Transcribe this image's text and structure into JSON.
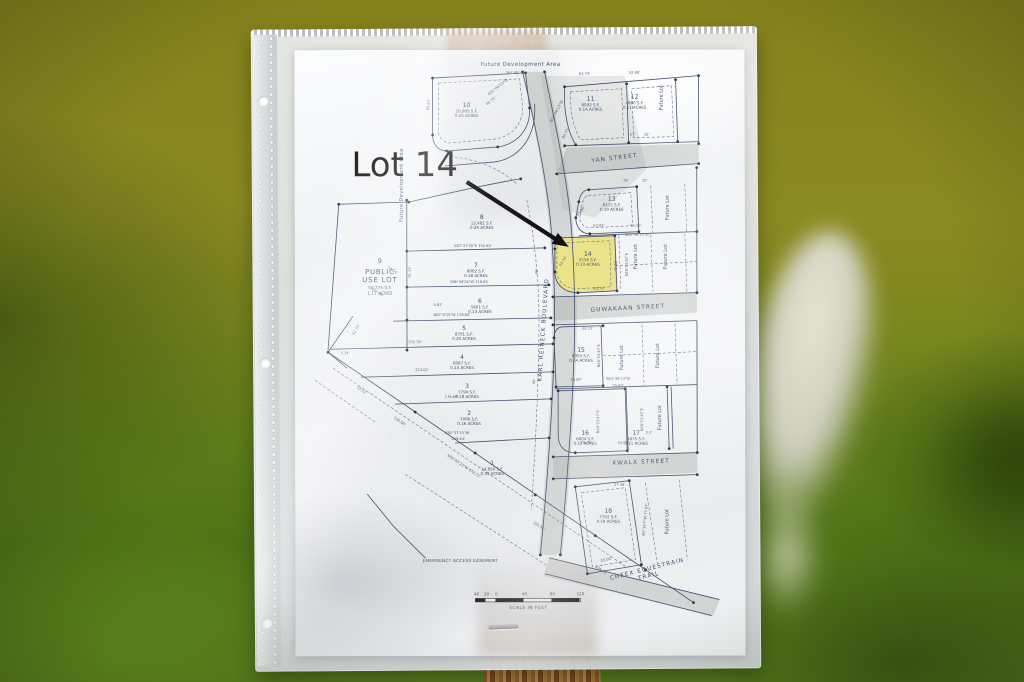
{
  "annotation": {
    "label": "Lot 14"
  },
  "colors": {
    "highlight": "#ece28a",
    "ink": "#44506a",
    "annotation": "#181818"
  },
  "map": {
    "titles": {
      "future_development_top": "Future Development Area",
      "future_development_left": "Future Development Area"
    },
    "public_lot": {
      "number": "9",
      "name_line1": "PUBLIC",
      "name_line2": "USE LOT",
      "area": "50,775 S.F.",
      "acres": "1.17 ACRES"
    },
    "future_lot_label": "Future Lot",
    "easement_label": "EMERGENCY ACCESS EASEMENT",
    "scale": {
      "ticks": [
        "40",
        "20",
        "0",
        "40",
        "80",
        "120"
      ],
      "caption": "SCALE IN FEET"
    },
    "streets": [
      {
        "name": "YAN STREET",
        "x": 320,
        "y": 110,
        "rot": -7
      },
      {
        "name": "GUWAKAAN STREET",
        "x": 333,
        "y": 260,
        "rot": -3
      },
      {
        "name": "KWALX STREET",
        "x": 346,
        "y": 414,
        "rot": -2
      },
      {
        "name": "KARL REINECK BOULEVARD",
        "x": 250,
        "y": 280,
        "rot": -86
      },
      {
        "name": "CHEEX EQUESTRAIN\nTRAIL",
        "x": 352,
        "y": 521,
        "rot": -14
      }
    ],
    "lots": [
      {
        "number": "1",
        "area": "14,850 S.F.",
        "acres": "0.34 ACRES",
        "x": 197,
        "y": 416
      },
      {
        "number": "2",
        "area": "7096 S.F.",
        "acres": "0.16 ACRES",
        "x": 174,
        "y": 366
      },
      {
        "number": "3",
        "area": "7794 S.F.",
        "acres": "0.18 ACRES",
        "x": 172,
        "y": 339
      },
      {
        "number": "4",
        "area": "6097 S.F.",
        "acres": "0.14 ACRES",
        "x": 167,
        "y": 310
      },
      {
        "number": "5",
        "area": "8701 S.F.",
        "acres": "0.20 ACRES",
        "x": 169,
        "y": 281
      },
      {
        "number": "6",
        "area": "5601 S.F.",
        "acres": "0.13 ACRES",
        "x": 185,
        "y": 254
      },
      {
        "number": "7",
        "area": "8002 S.F.",
        "acres": "0.18 ACRES",
        "x": 181,
        "y": 218
      },
      {
        "number": "8",
        "area": "12,481 S.F.",
        "acres": "0.29 ACRES",
        "x": 187,
        "y": 170
      },
      {
        "number": "10",
        "area": "10,905 S.F.",
        "acres": "0.25 ACRES",
        "x": 172,
        "y": 58
      },
      {
        "number": "11",
        "area": "6092 S.F.",
        "acres": "0.14 ACRES",
        "x": 296,
        "y": 52
      },
      {
        "number": "12",
        "area": "4880 S.F.",
        "acres": "0.11 ACRES",
        "x": 340,
        "y": 50
      },
      {
        "number": "13",
        "area": "8215 S.F.",
        "acres": "0.19 ACRES",
        "x": 317,
        "y": 152
      },
      {
        "number": "14",
        "area": "5556 S.F.",
        "acres": "0.13 ACRES",
        "x": 293,
        "y": 207
      },
      {
        "number": "15",
        "area": "6055 S.F.",
        "acres": "0.14 ACRES",
        "x": 286,
        "y": 303
      },
      {
        "number": "16",
        "area": "6604 S.F.",
        "acres": "0.15 ACRES",
        "x": 290,
        "y": 386
      },
      {
        "number": "17",
        "area": "4875 S.F.",
        "acres": "0.11 ACRES",
        "x": 341,
        "y": 386
      },
      {
        "number": "18",
        "area": "7792 S.F.",
        "acres": "0.18 ACRES",
        "x": 313,
        "y": 464
      }
    ],
    "future_lots": [
      {
        "x": 368,
        "y": 48
      },
      {
        "x": 374,
        "y": 158
      },
      {
        "x": 342,
        "y": 207
      },
      {
        "x": 372,
        "y": 207
      },
      {
        "x": 328,
        "y": 308
      },
      {
        "x": 364,
        "y": 306
      },
      {
        "x": 366,
        "y": 368
      },
      {
        "x": 373,
        "y": 472
      }
    ],
    "dimensions": [
      {
        "t": "167.90'",
        "x": 218,
        "y": 24,
        "r": 0
      },
      {
        "t": "55.57'",
        "x": 135,
        "y": 55,
        "r": -82
      },
      {
        "t": "63.74'",
        "x": 290,
        "y": 25,
        "r": 0
      },
      {
        "t": "52.90'",
        "x": 340,
        "y": 24,
        "r": 0
      },
      {
        "t": "N13°06'23\"W",
        "x": 263,
        "y": 62,
        "r": -62
      },
      {
        "t": "85.75'",
        "x": 272,
        "y": 84,
        "r": -62
      },
      {
        "t": "N31°06'23\"W",
        "x": 204,
        "y": 38,
        "r": -38
      },
      {
        "t": "85.75'",
        "x": 197,
        "y": 52,
        "r": -38
      },
      {
        "t": "57'",
        "x": 338,
        "y": 86,
        "r": 0
      },
      {
        "t": "15'",
        "x": 352,
        "y": 86,
        "r": 0
      },
      {
        "t": "78'",
        "x": 331,
        "y": 132,
        "r": 0
      },
      {
        "t": "15'",
        "x": 350,
        "y": 132,
        "r": 0
      },
      {
        "t": "45.80'",
        "x": 287,
        "y": 162,
        "r": -55
      },
      {
        "t": "53.93'",
        "x": 304,
        "y": 177,
        "r": 0
      },
      {
        "t": "55.50'",
        "x": 341,
        "y": 177,
        "r": 0
      },
      {
        "t": "S63°38'13\"W",
        "x": 342,
        "y": 186,
        "r": 0
      },
      {
        "t": "42.75'",
        "x": 269,
        "y": 212,
        "r": -55
      },
      {
        "t": "N26°21'47\"E",
        "x": 333,
        "y": 215,
        "r": -90
      },
      {
        "t": "49.35'",
        "x": 322,
        "y": 216,
        "r": -90
      },
      {
        "t": "45.75'",
        "x": 304,
        "y": 240,
        "r": 0
      },
      {
        "t": "62.71'",
        "x": 293,
        "y": 280,
        "r": 0
      },
      {
        "t": "74.09'",
        "x": 281,
        "y": 331,
        "r": 0
      },
      {
        "t": "S63°36'13\"W",
        "x": 323,
        "y": 330,
        "r": 0
      },
      {
        "t": "55.00'",
        "x": 323,
        "y": 337,
        "r": 0
      },
      {
        "t": "N26°21'47\"E",
        "x": 305,
        "y": 306,
        "r": -90
      },
      {
        "t": "N26°21'47\"E",
        "x": 304,
        "y": 372,
        "r": -90
      },
      {
        "t": "N26°21'47\"E",
        "x": 348,
        "y": 370,
        "r": -90
      },
      {
        "t": "78.76'",
        "x": 291,
        "y": 394,
        "r": 0
      },
      {
        "t": "55.03'",
        "x": 328,
        "y": 394,
        "r": 0
      },
      {
        "t": "2.5'",
        "x": 354,
        "y": 384,
        "r": 0
      },
      {
        "t": "57.38",
        "x": 324,
        "y": 436,
        "r": 0
      },
      {
        "t": "N7°34'7\"W 77.97'",
        "x": 351,
        "y": 470,
        "r": -84
      },
      {
        "t": "55.06'",
        "x": 311,
        "y": 511,
        "r": -13
      },
      {
        "t": "N87°27'35\"E 152.92'",
        "x": 178,
        "y": 197,
        "r": 0
      },
      {
        "t": "S86°44'26\"W 118.05",
        "x": 174,
        "y": 233,
        "r": 0
      },
      {
        "t": "N87°0'15\"W 178.04'",
        "x": 157,
        "y": 266,
        "r": 0
      },
      {
        "t": "252.76'",
        "x": 120,
        "y": 293,
        "r": 0
      },
      {
        "t": "213.02'",
        "x": 127,
        "y": 321,
        "r": 0
      },
      {
        "t": "176.68",
        "x": 156,
        "y": 348,
        "r": 0
      },
      {
        "t": "S81°37'15\"W",
        "x": 162,
        "y": 384,
        "r": 0
      },
      {
        "t": "139.44'",
        "x": 163,
        "y": 390,
        "r": 0
      },
      {
        "t": "53.52'",
        "x": 66,
        "y": 341,
        "r": 34
      },
      {
        "t": "135.06'",
        "x": 104,
        "y": 372,
        "r": 34
      },
      {
        "t": "N50°43'23\"W 478.72'",
        "x": 168,
        "y": 417,
        "r": 34
      },
      {
        "t": "105.57'",
        "x": 243,
        "y": 477,
        "r": 34
      },
      {
        "t": "104.20'",
        "x": 305,
        "y": 521,
        "r": 34
      },
      {
        "t": "3.34'",
        "x": 50,
        "y": 304,
        "r": 0
      },
      {
        "t": "52.74'",
        "x": 62,
        "y": 280,
        "r": -60
      },
      {
        "t": "74.34'",
        "x": 97,
        "y": 221,
        "r": 33
      },
      {
        "t": "167.08'",
        "x": 82,
        "y": 243,
        "r": 33
      },
      {
        "t": "91.13'",
        "x": 116,
        "y": 222,
        "r": -87
      },
      {
        "t": "9.87'",
        "x": 143,
        "y": 256,
        "r": 0
      },
      {
        "t": "40'",
        "x": 243,
        "y": 222,
        "r": -80
      },
      {
        "t": "40'",
        "x": 240,
        "y": 332,
        "r": -80
      }
    ]
  }
}
